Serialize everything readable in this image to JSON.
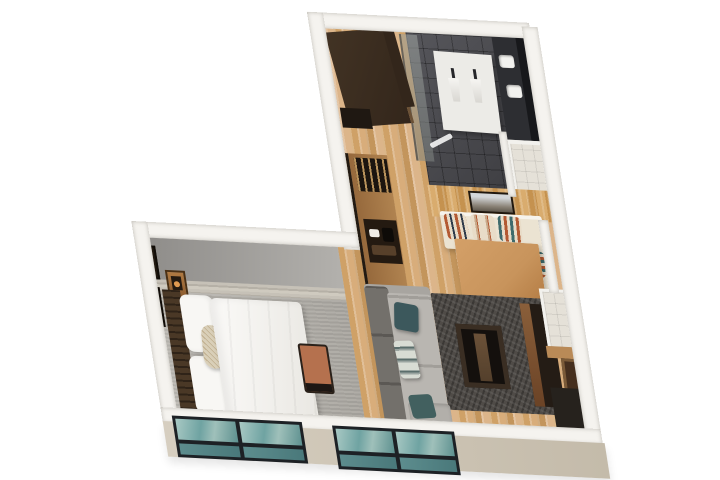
{
  "title": "3D isometric floor plan rendering of a studio suite",
  "colors": {
    "c-bg": "#ffffff",
    "c-wall": "#f5f3ef",
    "c-wall-beige": "#c4bbaa",
    "c-wood": "#d2a874",
    "c-wood-wall": "#c5924f",
    "c-tile-dark": "#3d3d41",
    "c-tile-light": "#e5e1d8",
    "c-carpet": "#aaa7a1",
    "c-stone": "#c6c1b7",
    "c-graywall1": "#8f8d8a",
    "c-graywall2": "#b3b1ad",
    "c-wardrobe": "#33261b",
    "c-wardrobe-edge": "#6b5136",
    "c-glassdoor": "rgba(128,133,130,0.55)",
    "c-partition": "#ecebe7",
    "c-counter": "#2d2e32",
    "c-mirror": "#17181b",
    "c-sink": "#f2f2ef",
    "c-bench-cream": "#ebe3d2",
    "c-table": "#c8945c",
    "c-table-edge": "#96662f",
    "c-leather": "#a9714e",
    "c-dark-frame": "#2c211a",
    "c-rug": "#4f4b47",
    "c-sofa-seat": "#b9b6b1",
    "c-sofa-back": "#73706b",
    "c-teal-pillow": "#3c585c",
    "c-bed-white": "#f8f7f4",
    "c-headboard1": "#4a3826",
    "c-headboard2": "#2f2318",
    "c-bolster": "#d9cfb8",
    "c-bench-cushion": "#b5714e",
    "c-art-frame": "#20180f",
    "c-door": "#452f1e",
    "c-door-frame": "#7a5a38",
    "c-mat": "#26221d",
    "c-win-frame": "#1d2125",
    "c-glass1": "#6fa3a2",
    "c-glass2": "#5d908f",
    "c-glass3": "#49787a",
    "c-rust": "#b35a33",
    "c-cream": "#e8dcc8",
    "c-tealstripe": "#3f6b6d",
    "c-navy": "#2e3a4a"
  },
  "scene": {
    "rooms": [
      {
        "name": "closet",
        "items": [
          "dark wardrobe panels",
          "wood floor"
        ]
      },
      {
        "name": "bathroom",
        "items": [
          "glass door",
          "white shower partition with two fixtures",
          "dark charcoal tile floor",
          "linear floor drain"
        ]
      },
      {
        "name": "vanity-area",
        "items": [
          "dark stone counter",
          "two white sinks",
          "mirror strip"
        ]
      },
      {
        "name": "water-closet",
        "items": [
          "light tile floor",
          "white partition walls"
        ]
      },
      {
        "name": "kitchenette",
        "items": [
          "tall wood cabinet",
          "glassware niche",
          "coffee-machine niche"
        ]
      },
      {
        "name": "hallway",
        "items": [
          "light oak plank flooring"
        ]
      },
      {
        "name": "dining-area",
        "items": [
          "wood plank accent wall",
          "framed artwork",
          "L-shaped cream banquette",
          "four striped pillows",
          "wood dining table",
          "two leather stools"
        ]
      },
      {
        "name": "bedroom",
        "items": [
          "gray accent wall",
          "stacked-stone trim",
          "gray carpet",
          "slatted headboard",
          "white king bed",
          "patterned bolster pillow",
          "wall art frames",
          "nightstand lamp",
          "terracotta foot bench"
        ]
      },
      {
        "name": "living-area",
        "items": [
          "gray L-sectional sofa",
          "teal and striped pillows",
          "charcoal patterned rug",
          "dark wood coffee table",
          "media console"
        ]
      },
      {
        "name": "entry",
        "items": [
          "light tile floor",
          "dark door",
          "dark floor mat",
          "wood threshold"
        ]
      }
    ],
    "exterior": [
      "white perimeter walls",
      "beige lower facade",
      "two dark-framed windows with teal glass"
    ]
  }
}
